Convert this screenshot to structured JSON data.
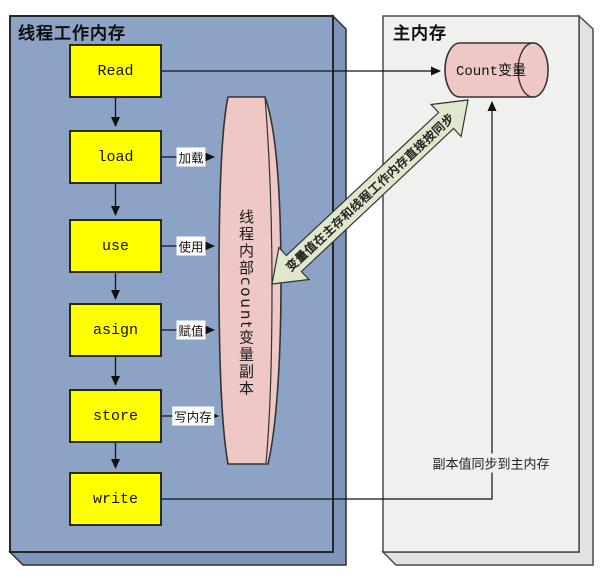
{
  "titles": {
    "thread_memory": "线程工作内存",
    "main_memory": "主内存"
  },
  "flow_boxes": [
    {
      "label": "Read"
    },
    {
      "label": "load",
      "edge_label": "加载"
    },
    {
      "label": "use",
      "edge_label": "使用"
    },
    {
      "label": "asign",
      "edge_label": "赋值"
    },
    {
      "label": "store",
      "edge_label": "写内存"
    },
    {
      "label": "write"
    }
  ],
  "cylinders": {
    "count": "Count变量",
    "thread_copy": "线程内部count变量副本"
  },
  "annotations": {
    "sync_arrow": "变量值在主存和线程工作内存直接按同步",
    "copy_sync": "副本值同步到主内存"
  },
  "colors": {
    "thread_panel": "#8ca3c6",
    "thread_panel_side": "#7d95ba",
    "flow_box": "#ffff00",
    "cylinder": "#efc7c5",
    "sync_arrow": "#dfe7cc",
    "main_panel": "#f0f0ee",
    "main_panel_side": "#e2e2e0"
  }
}
